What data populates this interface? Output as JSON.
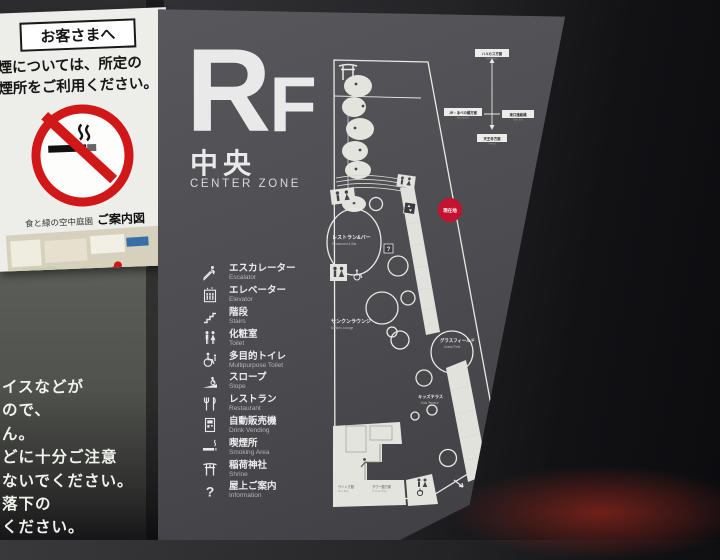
{
  "notice": {
    "header": "お客さまへ",
    "line1": "喫煙については、所定の",
    "line2": "喫煙所をご利用ください。",
    "map_title_pre": "食と緑の空中庭園",
    "map_title": "ご案内図",
    "smoking_label": "喫煙所"
  },
  "warning": [
    "イスなどが",
    "ので、",
    "ん。",
    "どに十分ご注意",
    "ないでください。",
    "落下の",
    "ください。"
  ],
  "sign": {
    "floor": "R",
    "floor_small": "F",
    "zone_jp": "中央",
    "zone_en": "CENTER ZONE",
    "legend": [
      {
        "icon": "escalator",
        "jp": "エスカレーター",
        "en": "Escalator"
      },
      {
        "icon": "elevator",
        "jp": "エレベーター",
        "en": "Elevator"
      },
      {
        "icon": "stairs",
        "jp": "階段",
        "en": "Stairs"
      },
      {
        "icon": "toilet",
        "jp": "化粧室",
        "en": "Toilet"
      },
      {
        "icon": "accessible-toilet",
        "jp": "多目的トイレ",
        "en": "Multipurpose Toilet"
      },
      {
        "icon": "slope",
        "jp": "スロープ",
        "en": "Slope"
      },
      {
        "icon": "restaurant",
        "jp": "レストラン",
        "en": "Restaurant"
      },
      {
        "icon": "vending",
        "jp": "自動販売機",
        "en": "Drink Vending"
      },
      {
        "icon": "smoking",
        "jp": "喫煙所",
        "en": "Smoking Area"
      },
      {
        "icon": "shrine",
        "jp": "稲荷神社",
        "en": "Shrine"
      },
      {
        "icon": "information",
        "jp": "屋上ご案内",
        "en": "Information"
      }
    ],
    "map": {
      "you_are_here": "現在地",
      "restaurant_bar_jp": "レストラン&バー",
      "restaurant_bar_en": "Restaurant & Bar",
      "lounge_jp": "サンクンラウンジ",
      "lounge_en": "Sunken Lounge",
      "grass_jp": "グラスフィールド",
      "grass_en": "Grass Field",
      "kids_jp": "キッズテラス",
      "kids_en": "Kids Terrace",
      "bldg_left_jp": "ウイング館",
      "bldg_left_en": "Wing Bldg.",
      "bldg_right_jp": "タワー館方面",
      "bldg_right_en": "To Tower Bldg.",
      "compass": {
        "top_jp": "ハルカス方面",
        "top_en": "HARUKAS",
        "left_jp": "JR・あべの橋方面",
        "left_en": "Abenobashi",
        "right_jp": "東口連絡橋",
        "right_en": "East Exit",
        "bottom_jp": "天王寺方面",
        "bottom_en": "Tennoji"
      }
    }
  },
  "colors": {
    "accent_red": "#c41230",
    "notice_red": "#d01818",
    "panel_gray": "#4c4c51"
  }
}
